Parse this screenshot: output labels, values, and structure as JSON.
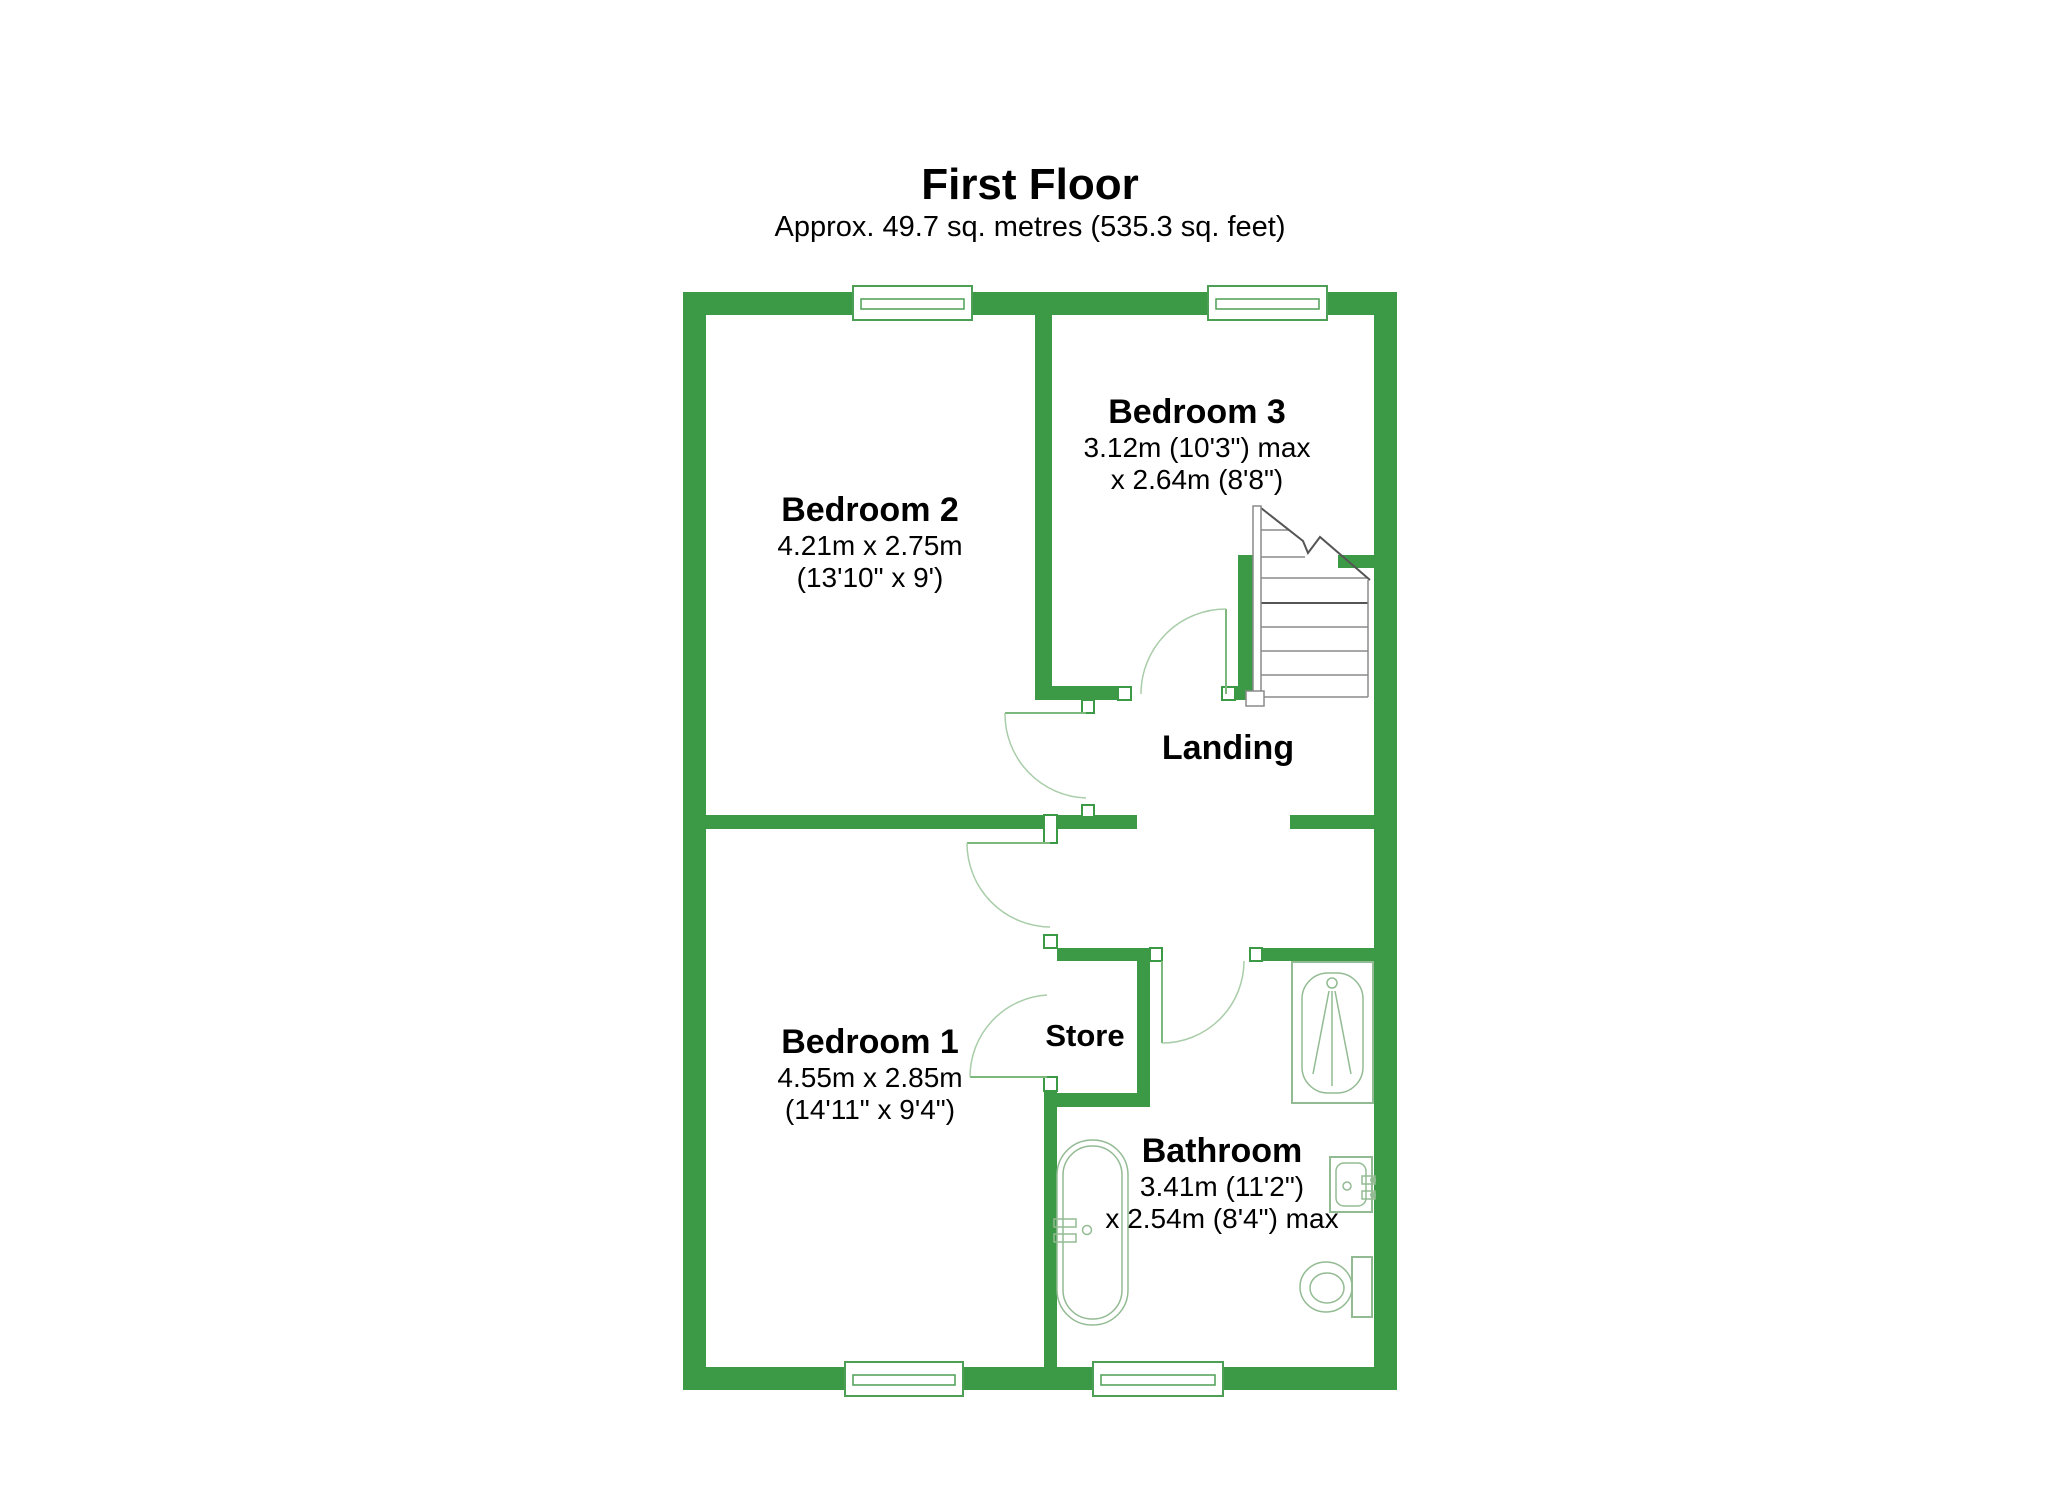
{
  "title": "First Floor",
  "subtitle": "Approx. 49.7 sq. metres (535.3 sq. feet)",
  "colors": {
    "wall_green": "#3c9a46",
    "window_frame": "#4d9f55",
    "door_leaf": "#7cb87c",
    "door_arc": "#a9cda9",
    "fixture_line": "#93bb93",
    "stair_line": "#8a8a8a",
    "stair_dark": "#555555",
    "text": "#000000"
  },
  "rooms": [
    {
      "id": "bedroom2",
      "name": "Bedroom 2",
      "dim1": "4.21m x 2.75m",
      "dim2": "(13'10\" x 9')"
    },
    {
      "id": "bedroom3",
      "name": "Bedroom 3",
      "dim1": "3.12m (10'3\") max",
      "dim2": "x 2.64m (8'8\")"
    },
    {
      "id": "landing",
      "name": "Landing"
    },
    {
      "id": "bedroom1",
      "name": "Bedroom 1",
      "dim1": "4.55m x 2.85m",
      "dim2": "(14'11\" x 9'4\")"
    },
    {
      "id": "store",
      "name": "Store"
    },
    {
      "id": "bathroom",
      "name": "Bathroom",
      "dim1": "3.41m (11'2\")",
      "dim2": "x 2.54m (8'4\") max"
    }
  ]
}
